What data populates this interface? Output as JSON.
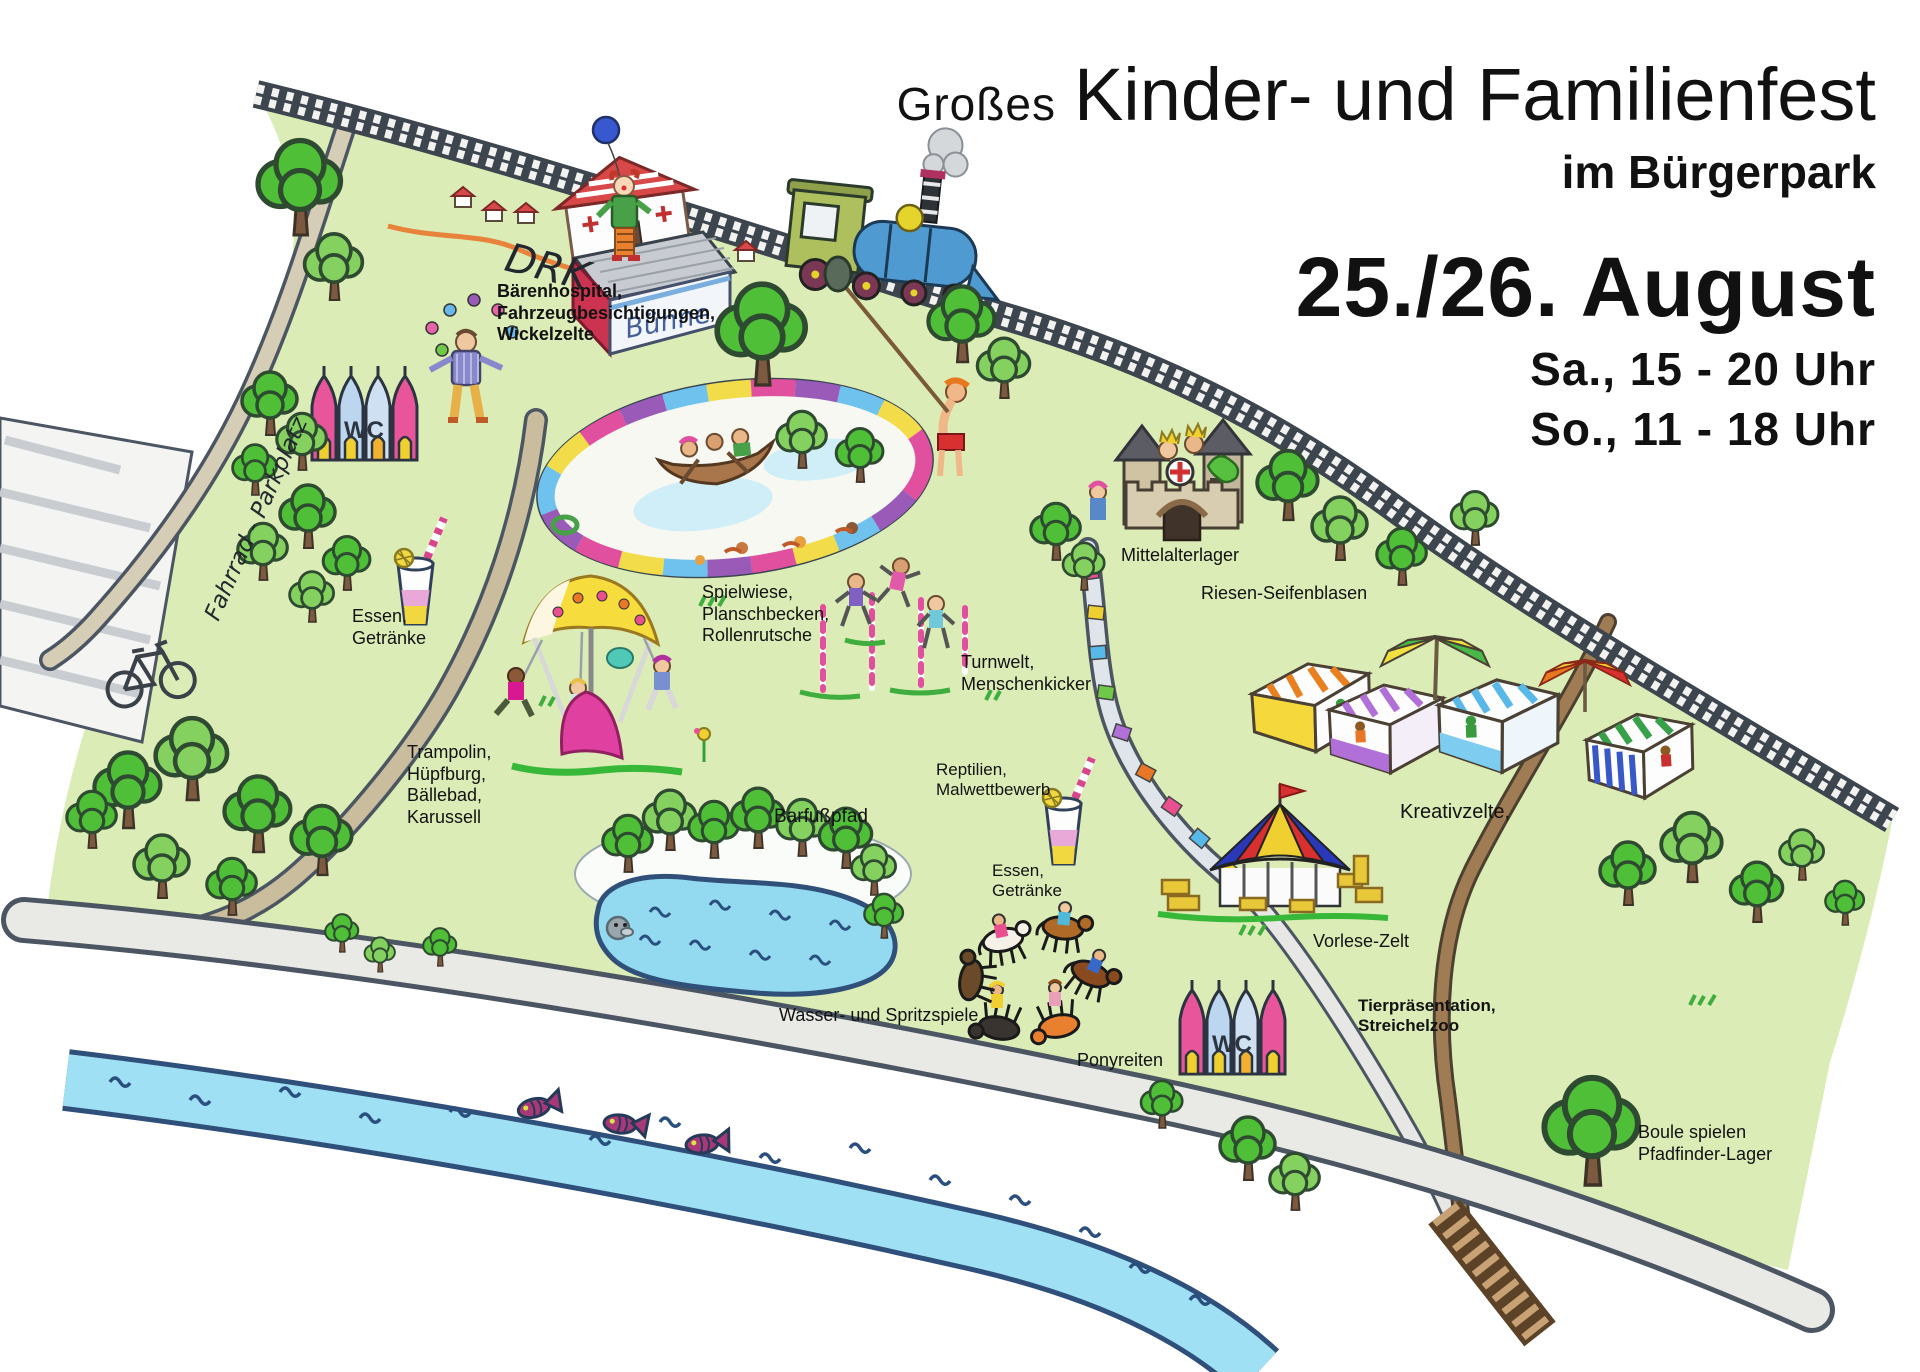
{
  "header": {
    "title_prefix": "Großes",
    "title_main": "Kinder- und Familienfest",
    "subtitle": "im Bürgerpark",
    "date": "25./26. August",
    "time_saturday": "Sa., 15 - 20 Uhr",
    "time_sunday": "So., 11 - 18 Uhr"
  },
  "map": {
    "stage_sign": "Bühne",
    "wc_label": "WC",
    "labels": [
      {
        "id": "drk",
        "lines": [
          "DRK"
        ],
        "x": 512,
        "y": 234,
        "size": 40,
        "rotate": 14,
        "handwritten": true
      },
      {
        "id": "drk-services",
        "lines": [
          "Bärenhospital,",
          "Fahrzeugbesichtigungen,",
          "Wickelzelte"
        ],
        "x": 497,
        "y": 281,
        "size": 18,
        "bold": true
      },
      {
        "id": "fahrrad-parkplatz",
        "lines": [
          "Fahrrad - Parkplatz"
        ],
        "x": 200,
        "y": 614,
        "size": 23,
        "rotate": -66,
        "handwritten": true
      },
      {
        "id": "essen-getraenke-west",
        "lines": [
          "Essen,",
          "Getränke"
        ],
        "x": 352,
        "y": 606,
        "size": 18
      },
      {
        "id": "trampolin",
        "lines": [
          "Trampolin,",
          "Hüpfburg,",
          "Bällebad,",
          "Karussell"
        ],
        "x": 407,
        "y": 742,
        "size": 18
      },
      {
        "id": "spielwiese",
        "lines": [
          "Spielwiese,",
          "Planschbecken,",
          "Rollenrutsche"
        ],
        "x": 702,
        "y": 582,
        "size": 18
      },
      {
        "id": "turnwelt",
        "lines": [
          "Turnwelt,",
          "Menschenkicker"
        ],
        "x": 961,
        "y": 652,
        "size": 18
      },
      {
        "id": "mittelalterlager",
        "lines": [
          "Mittelalterlager"
        ],
        "x": 1121,
        "y": 545,
        "size": 18
      },
      {
        "id": "riesen-seifenblasen",
        "lines": [
          "Riesen-Seifenblasen"
        ],
        "x": 1201,
        "y": 583,
        "size": 18
      },
      {
        "id": "barfusspfad",
        "lines": [
          "Barfußpfad"
        ],
        "x": 774,
        "y": 806,
        "size": 19
      },
      {
        "id": "reptilien-malwettbewerb",
        "lines": [
          "Reptilien,",
          "Malwettbewerb"
        ],
        "x": 936,
        "y": 760,
        "size": 17
      },
      {
        "id": "essen-getraenke-ost",
        "lines": [
          "Essen,",
          "Getränke"
        ],
        "x": 992,
        "y": 861,
        "size": 17
      },
      {
        "id": "wasser-spritzspiele",
        "lines": [
          "Wasser- und Spritzspiele"
        ],
        "x": 779,
        "y": 1005,
        "size": 18
      },
      {
        "id": "ponyreiten",
        "lines": [
          "Ponyreiten"
        ],
        "x": 1077,
        "y": 1050,
        "size": 18
      },
      {
        "id": "kreativzelte",
        "lines": [
          "Kreativzelte,"
        ],
        "x": 1400,
        "y": 800,
        "size": 20
      },
      {
        "id": "vorlese-zelt",
        "lines": [
          "Vorlese-Zelt"
        ],
        "x": 1313,
        "y": 931,
        "size": 18
      },
      {
        "id": "tierpraesentation",
        "lines": [
          "Tierpräsentation,",
          "Streichelzoo"
        ],
        "x": 1358,
        "y": 996,
        "size": 17,
        "bold": true
      },
      {
        "id": "boule-pfadfinder",
        "lines": [
          "Boule spielen",
          "Pfadfinder-Lager"
        ],
        "x": 1638,
        "y": 1122,
        "size": 18
      }
    ]
  },
  "colors": {
    "park_green": "#dcecb6",
    "canopy_green": "#4fbf38",
    "canopy_light": "#85d160",
    "river_blue": "#a0e0f4",
    "river_edge": "#30507c",
    "road_gray": "#e9e9e6",
    "road_edge": "#4c5662",
    "path_tan": "#c9bd9e",
    "rail_dark": "#3d454e",
    "accent_pink": "#e0509e",
    "accent_yellow": "#f2dc4a",
    "accent_blue": "#6fc2ee",
    "accent_purple": "#9a5ab8",
    "accent_red": "#d83030"
  }
}
